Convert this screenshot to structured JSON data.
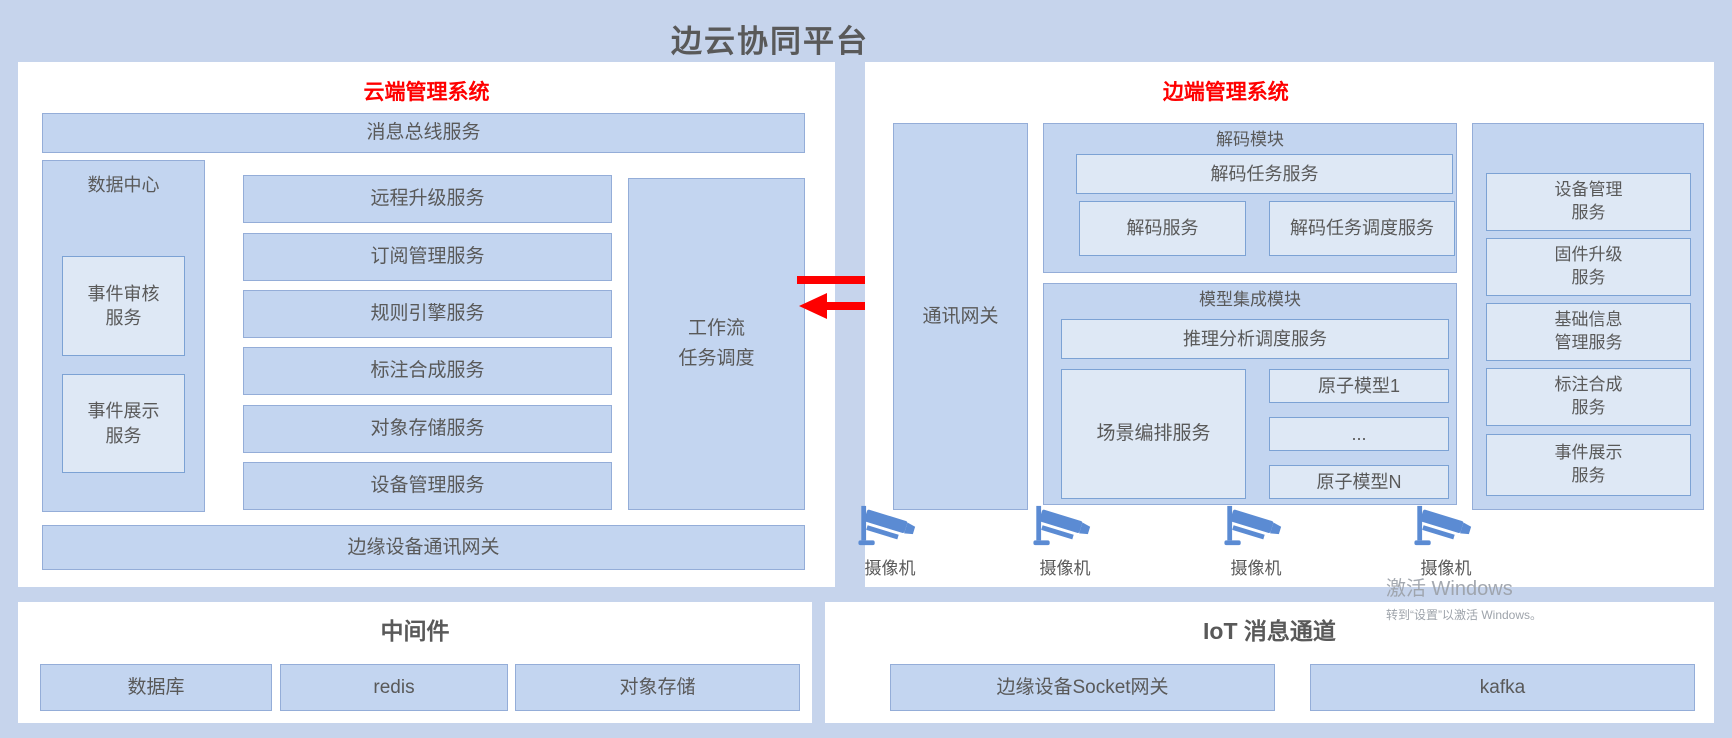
{
  "title": "边云协同平台",
  "cloud": {
    "header": "云端管理系统",
    "bus": "消息总线服务",
    "data_center": {
      "title": "数据中心",
      "items": [
        "事件审核\n服务",
        "事件展示\n服务"
      ]
    },
    "services": [
      "远程升级服务",
      "订阅管理服务",
      "规则引擎服务",
      "标注合成服务",
      "对象存储服务",
      "设备管理服务"
    ],
    "workflow": "工作流\n任务调度",
    "gateway": "边缘设备通讯网关"
  },
  "edge": {
    "header": "边端管理系统",
    "comm_gateway": "通讯网关",
    "decode": {
      "title": "解码模块",
      "task": "解码任务服务",
      "service": "解码服务",
      "scheduler": "解码任务调度服务"
    },
    "model": {
      "title": "模型集成模块",
      "scheduler": "推理分析调度服务",
      "scene": "场景编排服务",
      "models": [
        "原子模型1",
        "...",
        "原子模型N"
      ]
    },
    "device_services": [
      "设备管理\n服务",
      "固件升级\n服务",
      "基础信息\n管理服务",
      "标注合成\n服务",
      "事件展示\n服务"
    ],
    "camera_label": "摄像机"
  },
  "middleware": {
    "header": "中间件",
    "items": [
      "数据库",
      "redis",
      "对象存储"
    ]
  },
  "iot": {
    "header": "IoT 消息通道",
    "items": [
      "边缘设备Socket网关",
      "kafka"
    ]
  },
  "watermark": {
    "line1": "激活 Windows",
    "line2": "转到“设置”以激活 Windows。"
  },
  "colors": {
    "page_bg": "#c6d4ec",
    "panel_bg": "#ffffff",
    "box_fill": "#c3d5f0",
    "box_fill_light": "#dee8f5",
    "box_border": "#94add8",
    "box_border_light": "#7ca2d4",
    "accent_red": "#ff0000",
    "text_gray": "#595959",
    "camera_blue": "#5b8bd3"
  }
}
